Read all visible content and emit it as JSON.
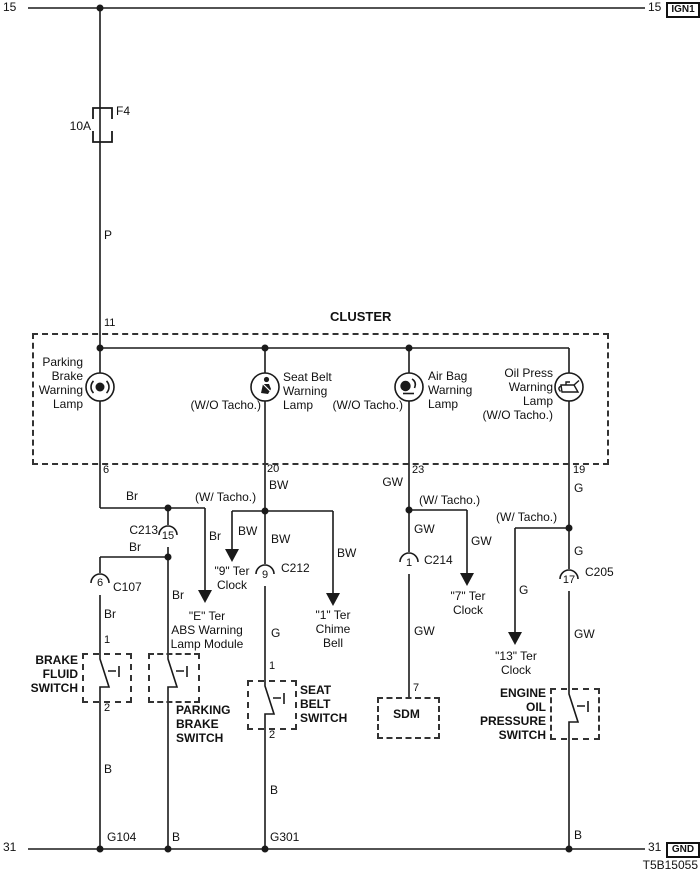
{
  "colors": {
    "line": "#1a1a1a",
    "background": "#ffffff"
  },
  "top_rail": {
    "left_terminal": "15",
    "right_terminal": "15",
    "right_tag": "IGN1"
  },
  "fuse": {
    "name": "F4",
    "rating": "10A"
  },
  "wire_p": "P",
  "cluster": {
    "title": "CLUSTER",
    "input_pin": "11",
    "parking": {
      "label1": "Parking",
      "label2": "Brake",
      "label3": "Warning",
      "label4": "Lamp",
      "pin": "6"
    },
    "seatbelt": {
      "wo_tacho": "(W/O Tacho.)",
      "label1": "Seat Belt",
      "label2": "Warning",
      "label3": "Lamp",
      "pin": "20"
    },
    "airbag": {
      "wo_tacho": "(W/O Tacho.)",
      "label1": "Air Bag",
      "label2": "Warning",
      "label3": "Lamp",
      "pin": "23"
    },
    "oil": {
      "label1": "Oil Press",
      "label2": "Warning",
      "label3": "Lamp",
      "label4": "(W/O Tacho.)",
      "pin": "19"
    }
  },
  "parking_circuit": {
    "wire_br_1": "Br",
    "branch_wire_br": "Br",
    "abs_module": {
      "line1": "\"E\" Ter",
      "line2": "ABS Warning",
      "line3": "Lamp Module"
    },
    "c213": {
      "name": "C213",
      "pin": "15"
    },
    "wire_br_2": "Br",
    "wire_br_3": "Br",
    "wire_br_4": "Br",
    "c107": {
      "name": "C107",
      "pin": "6"
    },
    "brake_fluid_switch": {
      "pin_top": "1",
      "label1": "BRAKE",
      "label2": "FLUID",
      "label3": "SWITCH",
      "pin_bottom": "2"
    },
    "wire_b_1": "B",
    "ground_g104": "G104",
    "parking_switch": {
      "label1": "PARKING",
      "label2": "BRAKE",
      "label3": "SWITCH"
    },
    "wire_b_2": "B"
  },
  "seatbelt_circuit": {
    "wire_bw_1": "BW",
    "w_tacho": "(W/ Tacho.)",
    "clock9_branch": {
      "wire": "BW",
      "line1": "\"9\" Ter",
      "line2": "Clock"
    },
    "chime_branch": {
      "wire": "BW",
      "line1": "\"1\" Ter",
      "line2": "Chime",
      "line3": "Bell"
    },
    "wire_bw_2": "BW",
    "c212": {
      "name": "C212",
      "pin": "9"
    },
    "wire_g": "G",
    "switch": {
      "pin_top": "1",
      "label1": "SEAT",
      "label2": "BELT",
      "label3": "SWITCH",
      "pin_bottom": "2"
    },
    "wire_b": "B",
    "ground_g301": "G301"
  },
  "airbag_circuit": {
    "wire_gw_1": "GW",
    "w_tacho": "(W/ Tacho.)",
    "clock7_branch": {
      "wire": "GW",
      "line1": "\"7\" Ter",
      "line2": "Clock"
    },
    "wire_gw_2": "GW",
    "c214": {
      "name": "C214",
      "pin": "1"
    },
    "wire_gw_3": "GW",
    "sdm": {
      "pin": "7",
      "label": "SDM"
    }
  },
  "oil_circuit": {
    "wire_g_1": "G",
    "w_tacho": "(W/ Tacho.)",
    "clock13_branch": {
      "wire": "G",
      "line1": "\"13\" Ter",
      "line2": "Clock"
    },
    "wire_g_2": "G",
    "c205": {
      "name": "C205",
      "pin": "17"
    },
    "wire_gw": "GW",
    "switch": {
      "label1": "ENGINE",
      "label2": "OIL",
      "label3": "PRESSURE",
      "label4": "SWITCH"
    },
    "wire_b": "B"
  },
  "ground_rail": {
    "left_terminal": "31",
    "right_terminal": "31",
    "right_tag": "GND"
  },
  "doc_code": "T5B15055"
}
